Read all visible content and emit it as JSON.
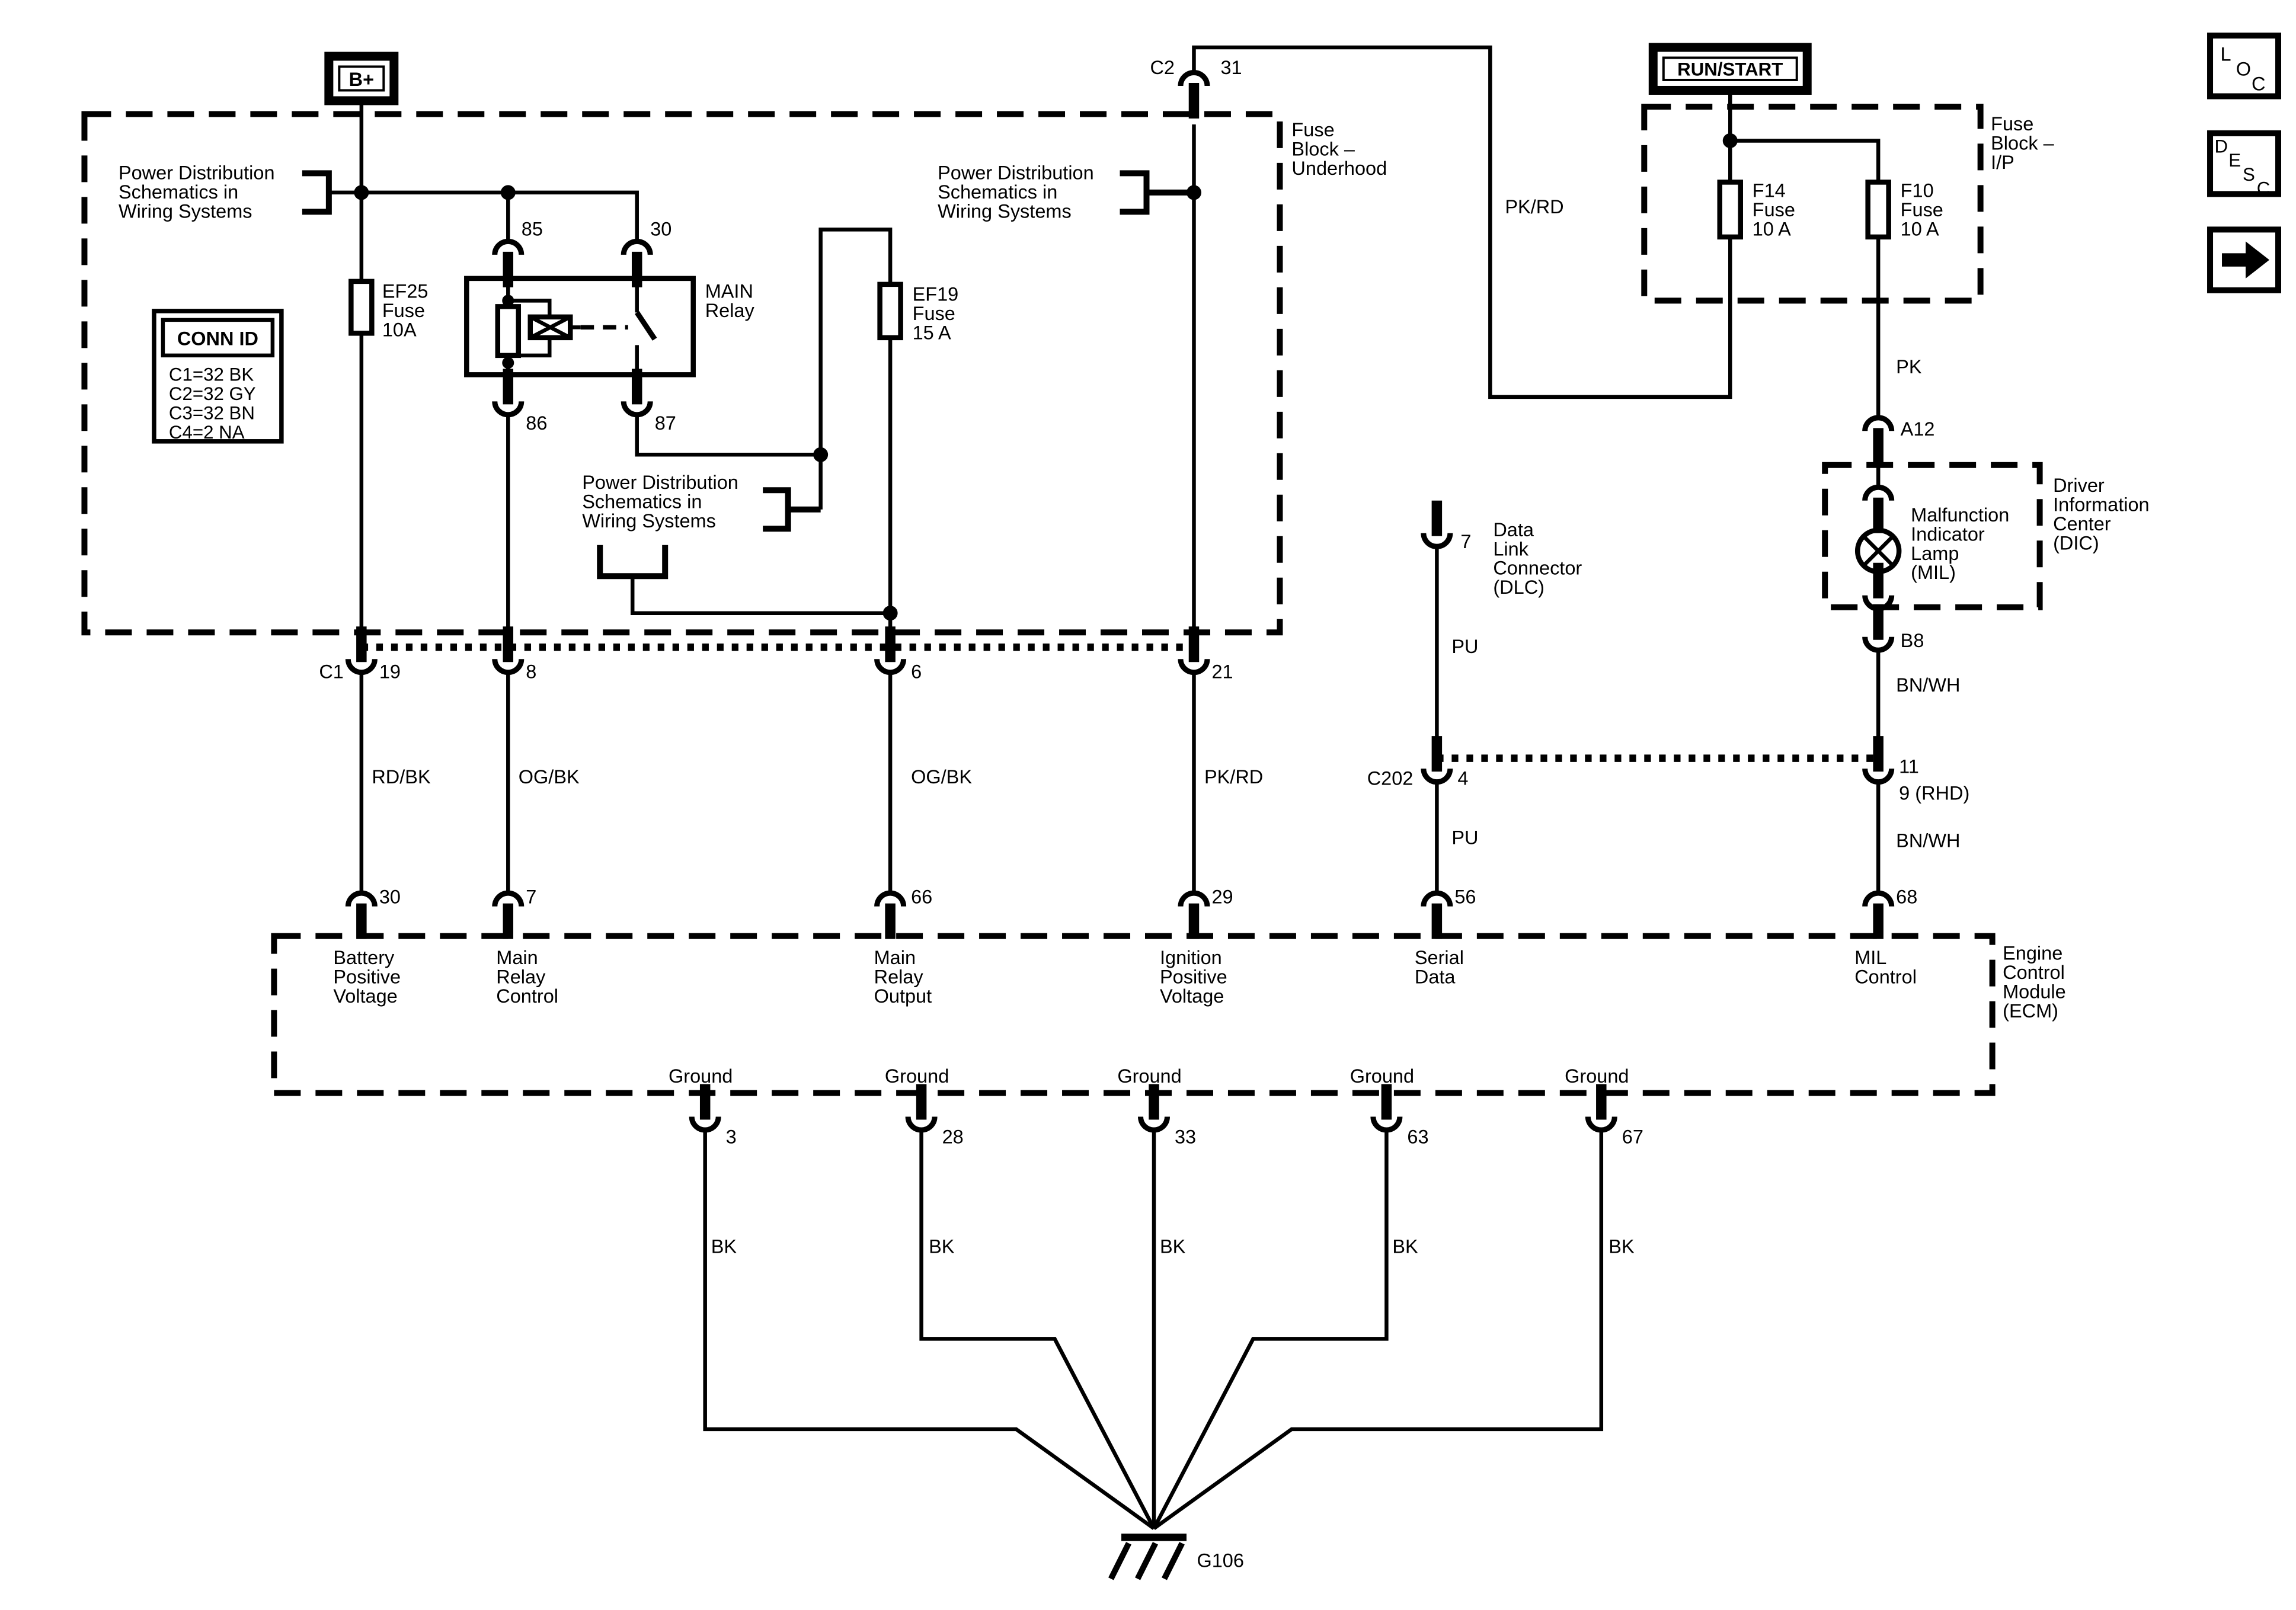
{
  "colors": {
    "ink": "#000000",
    "paper": "#ffffff"
  },
  "title_terminals": {
    "b_plus": "B+",
    "run_start": "RUN/START"
  },
  "toolbar": {
    "buttons": [
      {
        "id": "loc",
        "label": "LOC"
      },
      {
        "id": "desc",
        "label": "DESC"
      },
      {
        "id": "forward",
        "icon": "right-arrow"
      }
    ]
  },
  "conn_id": {
    "title": "CONN ID",
    "rows": [
      "C1=32 BK",
      "C2=32 GY",
      "C3=32 BN",
      "C4=2 NA"
    ]
  },
  "notes": {
    "power_dist": "Power Distribution\nSchematics in\nWiring Systems"
  },
  "blocks": {
    "underhood": "Fuse\nBlock –\nUnderhood",
    "ip": "Fuse\nBlock –\nI/P",
    "dic": "Driver\nInformation\nCenter\n(DIC)",
    "ecm": "Engine\nControl\nModule\n(ECM)"
  },
  "components": {
    "mil": "Malfunction\nIndicator\nLamp\n(MIL)",
    "dlc": "Data\nLink\nConnector\n(DLC)",
    "relay": "MAIN\nRelay",
    "ef25": "EF25\nFuse\n10A",
    "ef19": "EF19\nFuse\n15 A",
    "f14": "F14\nFuse\n10 A",
    "f10": "F10\nFuse\n10 A"
  },
  "relay_pins": {
    "p85": "85",
    "p30": "30",
    "p86": "86",
    "p87": "87"
  },
  "c2": {
    "name": "C2",
    "pin": "31"
  },
  "c1": {
    "name": "C1",
    "pins": [
      "19",
      "8",
      "6",
      "21"
    ]
  },
  "c202": {
    "name": "C202",
    "pin_left": "4",
    "pin_right_top": "11",
    "pin_right_bottom": "9 (RHD)"
  },
  "dlc_pin": "7",
  "dic_pins": {
    "top": "A12",
    "bottom": "B8"
  },
  "wire_colors": {
    "rd_bk": "RD/BK",
    "og_bk_a": "OG/BK",
    "og_bk_b": "OG/BK",
    "pk_rd_branch": "PK/RD",
    "pk_rd_main": "PK/RD",
    "pk": "PK",
    "pu_a": "PU",
    "pu_b": "PU",
    "bn_wh_a": "BN/WH",
    "bn_wh_b": "BN/WH",
    "bk": [
      "BK",
      "BK",
      "BK",
      "BK",
      "BK"
    ]
  },
  "ecm": {
    "pins": [
      {
        "num": "30",
        "label": "Battery\nPositive\nVoltage"
      },
      {
        "num": "7",
        "label": "Main\nRelay\nControl"
      },
      {
        "num": "66",
        "label": "Main\nRelay\nOutput"
      },
      {
        "num": "29",
        "label": "Ignition\nPositive\nVoltage"
      },
      {
        "num": "56",
        "label": "Serial\nData"
      },
      {
        "num": "68",
        "label": "MIL\nControl"
      }
    ],
    "grounds": [
      {
        "label": "Ground",
        "pin": "3"
      },
      {
        "label": "Ground",
        "pin": "28"
      },
      {
        "label": "Ground",
        "pin": "33"
      },
      {
        "label": "Ground",
        "pin": "63"
      },
      {
        "label": "Ground",
        "pin": "67"
      }
    ],
    "ground_ref": "G106"
  }
}
